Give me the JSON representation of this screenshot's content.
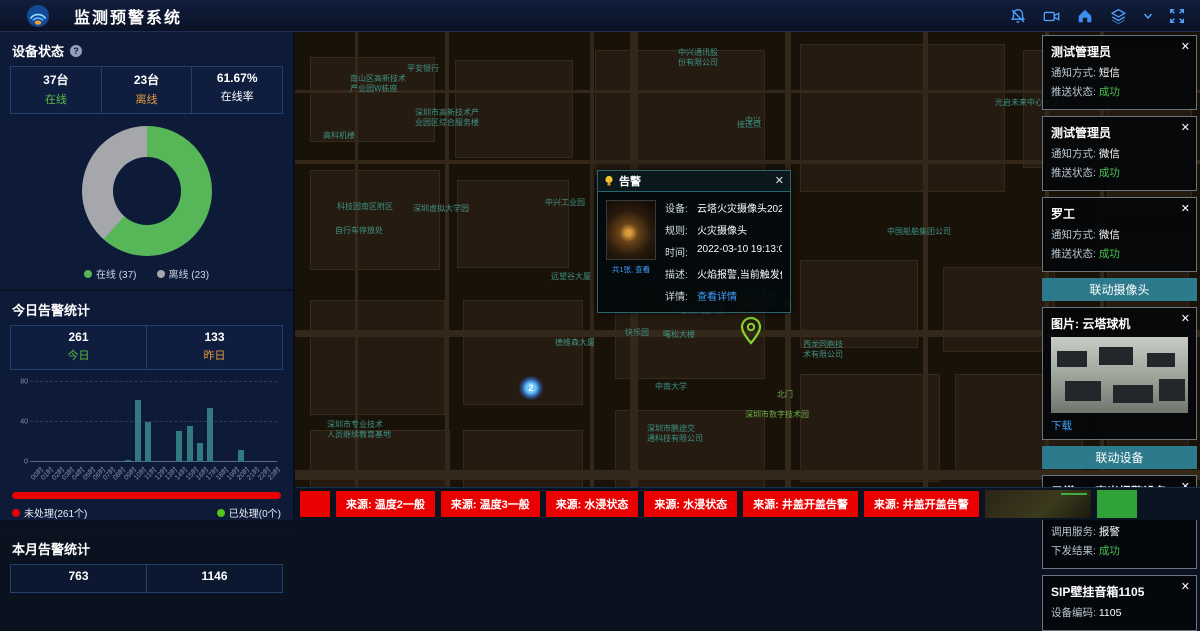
{
  "theme": {
    "accent_blue": "#4da3ff",
    "green": "#52c41a",
    "orange": "#e09a3c",
    "teal": "#2c7a8c",
    "red": "#ea0000",
    "link_blue": "#40a0ff",
    "map_label": "#3f9286"
  },
  "header": {
    "title": "监测预警系统",
    "icons": [
      {
        "name": "notification-off-icon"
      },
      {
        "name": "video-camera-icon"
      },
      {
        "name": "home-icon"
      },
      {
        "name": "layers-icon"
      },
      {
        "name": "chevron-down-icon"
      },
      {
        "name": "fullscreen-icon"
      }
    ]
  },
  "left_panel": {
    "device_status": {
      "title": "设备状态",
      "stats": [
        {
          "value": "37台",
          "label": "在线",
          "color": "#5dbb43"
        },
        {
          "value": "23台",
          "label": "离线",
          "color": "#e09a3c"
        },
        {
          "value": "61.67%",
          "label": "在线率",
          "color": "#ffffff"
        }
      ]
    },
    "today_alerts": {
      "title": "今日告警统计",
      "stats": [
        {
          "value": "261",
          "label": "今日",
          "color": "#5dbb43"
        },
        {
          "value": "133",
          "label": "昨日",
          "color": "#e09a3c"
        }
      ],
      "progress": {
        "unprocessed_label": "未处理(261个)",
        "processed_label": "已处理(0个)",
        "unprocessed_pct": 100
      }
    },
    "month_alerts": {
      "title": "本月告警统计",
      "stats": [
        {
          "value": "763",
          "label": ""
        },
        {
          "value": "1146",
          "label": ""
        }
      ]
    }
  },
  "chart_data": [
    {
      "type": "pie",
      "donut": true,
      "title": "设备状态",
      "labels": [
        "在线 (37)",
        "离线 (23)"
      ],
      "values": [
        37,
        23
      ],
      "colors": [
        "#57b657",
        "#a6a6ad"
      ],
      "legend_position": "bottom"
    },
    {
      "type": "bar",
      "title": "今日告警统计(按小时)",
      "categories": [
        "00时",
        "01时",
        "02时",
        "03时",
        "04时",
        "05时",
        "06时",
        "07时",
        "08时",
        "09时",
        "10时",
        "11时",
        "12时",
        "13时",
        "14时",
        "15时",
        "16时",
        "17时",
        "18时",
        "19时",
        "20时",
        "21时",
        "22时",
        "23时"
      ],
      "values": [
        0,
        0,
        0,
        0,
        0,
        0,
        0,
        0,
        0,
        2,
        62,
        40,
        0,
        0,
        31,
        36,
        19,
        54,
        0,
        0,
        12,
        0,
        0,
        0
      ],
      "xlabel": "",
      "ylabel": "",
      "ylim": [
        0,
        80
      ],
      "yticks": [
        0,
        40,
        80
      ],
      "bar_color": "#327a80",
      "grid": true
    }
  ],
  "map": {
    "labels": [
      {
        "text": "中兴通讯股\n份有限公司",
        "x": 383,
        "y": 16
      },
      {
        "text": "中兴",
        "x": 450,
        "y": 84
      },
      {
        "text": "光启未来中心大厦",
        "x": 700,
        "y": 66
      },
      {
        "text": "平安银行",
        "x": 112,
        "y": 32
      },
      {
        "text": "南山区高新技术\n产业园W栋座",
        "x": 55,
        "y": 42
      },
      {
        "text": "深圳市高新技术产\n业园区综合服务楼",
        "x": 120,
        "y": 76
      },
      {
        "text": "高科机楼",
        "x": 28,
        "y": 99
      },
      {
        "text": "科技园南区附区",
        "x": 42,
        "y": 170
      },
      {
        "text": "深圳虚拟大学园",
        "x": 118,
        "y": 172
      },
      {
        "text": "自行车停放处",
        "x": 40,
        "y": 194
      },
      {
        "text": "中兴工业园",
        "x": 250,
        "y": 166
      },
      {
        "text": "中国船舶集团公司",
        "x": 592,
        "y": 195
      },
      {
        "text": "接送点",
        "x": 442,
        "y": 88
      },
      {
        "text": "远望谷大厦",
        "x": 256,
        "y": 240
      },
      {
        "text": "德维森大厦",
        "x": 260,
        "y": 306
      },
      {
        "text": "快乐园",
        "x": 330,
        "y": 296
      },
      {
        "text": "曙松大厦2期",
        "x": 384,
        "y": 274
      },
      {
        "text": "曙松大楼",
        "x": 368,
        "y": 298
      },
      {
        "text": "深圳国家工\n程实验室大楼",
        "x": 448,
        "y": 258,
        "green": true
      },
      {
        "text": "西龙同胞技\n术有限公司",
        "x": 508,
        "y": 308
      },
      {
        "text": "中南大学",
        "x": 360,
        "y": 350
      },
      {
        "text": "北门",
        "x": 482,
        "y": 358,
        "green": true
      },
      {
        "text": "深圳市数字技术园",
        "x": 450,
        "y": 378,
        "green": true
      },
      {
        "text": "深圳市鹏途交\n通科技有限公司",
        "x": 352,
        "y": 392
      },
      {
        "text": "深圳市专业技术\n人员继续教育基地",
        "x": 32,
        "y": 388
      }
    ],
    "markers": [
      {
        "type": "pin",
        "name": "alert-location-pin",
        "x": 444,
        "y": 284
      },
      {
        "type": "dot",
        "name": "device-cluster-dot",
        "label": "2",
        "x": 224,
        "y": 344
      }
    ],
    "popup": {
      "title": "告警",
      "thumbnail_caption": "共1张, 查看",
      "fields": [
        {
          "label": "设备:",
          "value": "云塔火灾摄像头202"
        },
        {
          "label": "规则:",
          "value": "火灾摄像头"
        },
        {
          "label": "时间:",
          "value": "2022-03-10 19:13:07"
        },
        {
          "label": "描述:",
          "value": "火焰报警,当前触发值为"
        },
        {
          "label": "详情:",
          "value": "查看详情",
          "link": true
        }
      ]
    }
  },
  "right_panel": {
    "notification_cards": [
      {
        "title": "测试管理员",
        "fields": [
          {
            "label": "通知方式:",
            "value": "短信"
          },
          {
            "label": "推送状态:",
            "value": "成功",
            "success": true
          }
        ]
      },
      {
        "title": "测试管理员",
        "fields": [
          {
            "label": "通知方式:",
            "value": "微信"
          },
          {
            "label": "推送状态:",
            "value": "成功",
            "success": true
          }
        ]
      },
      {
        "title": "罗工",
        "fields": [
          {
            "label": "通知方式:",
            "value": "微信"
          },
          {
            "label": "推送状态:",
            "value": "成功",
            "success": true
          }
        ]
      }
    ],
    "camera_section": {
      "header": "联动摄像头",
      "card": {
        "title": "图片: 云塔球机",
        "action": "下载"
      }
    },
    "device_section": {
      "header": "联动设备",
      "cards": [
        {
          "title": "云塔307声光报警设备",
          "fields": [
            {
              "label": "设备编码:",
              "value": "ffffff100001ab6c"
            },
            {
              "label": "调用服务:",
              "value": "报警"
            },
            {
              "label": "下发结果:",
              "value": "成功",
              "success": true
            }
          ]
        },
        {
          "title": "SIP壁挂音箱1105",
          "fields": [
            {
              "label": "设备编码:",
              "value": "1105"
            }
          ]
        }
      ]
    }
  },
  "bottom_bar": {
    "alerts": [
      "",
      "来源: 温度2一般",
      "来源: 温度3一般",
      "来源: 水浸状态",
      "来源: 水浸状态",
      "来源: 井盖开盖告警",
      "来源: 井盖开盖告警"
    ],
    "thumbnails": [
      {
        "name": "camera-feed-thumbnail",
        "kind": "cam"
      },
      {
        "name": "green-screen-thumbnail",
        "kind": "green"
      }
    ]
  }
}
